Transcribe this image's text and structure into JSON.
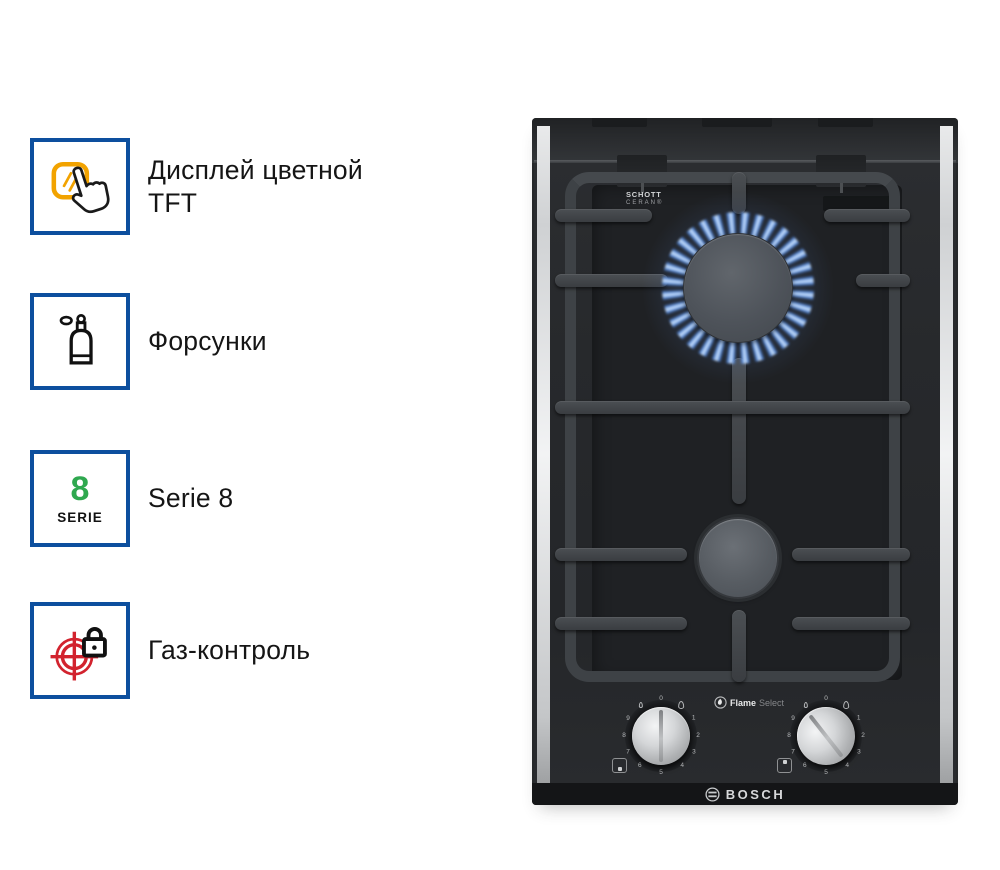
{
  "page": {
    "background": "#ffffff"
  },
  "features": {
    "icon_border_color": "#0d4f9e",
    "accent_orange": "#f2a300",
    "accent_green": "#2fa84f",
    "accent_red": "#d2232e",
    "items": [
      {
        "name": "tft-display",
        "label": "Дисплей цветной TFT"
      },
      {
        "name": "nozzles",
        "label": "Форсунки"
      },
      {
        "name": "serie-8",
        "label": "Serie 8",
        "badge_number": "8",
        "badge_text": "SERIE"
      },
      {
        "name": "gas-control",
        "label": "Газ-контроль"
      }
    ]
  },
  "product": {
    "brand": "BOSCH",
    "glass_brand_line1": "SCHOTT",
    "glass_brand_line2": "CERAN®",
    "feature_logo": {
      "bold": "Flame",
      "light": "Select"
    },
    "knobs": {
      "marks": [
        "0",
        "1",
        "2",
        "3",
        "4",
        "5",
        "6",
        "7",
        "8",
        "9"
      ],
      "left_pointer_deg": 0,
      "right_pointer_deg": -38
    },
    "burners": [
      {
        "position": "top",
        "state": "lit",
        "flame_color": "#5b8bd8"
      },
      {
        "position": "bottom",
        "state": "off"
      }
    ]
  }
}
